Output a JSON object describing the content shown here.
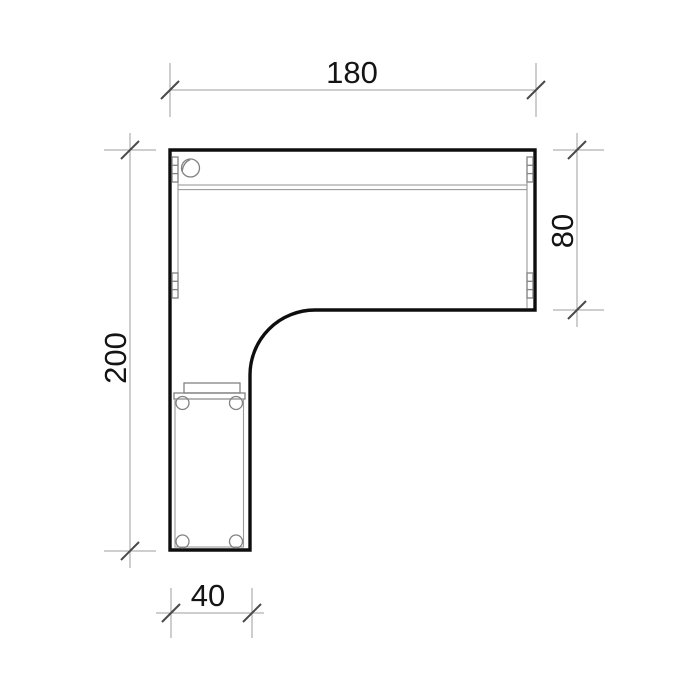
{
  "drawing": {
    "kind": "technical-plan-drawing",
    "dimensions": {
      "top": {
        "label": "180"
      },
      "right": {
        "label": "80"
      },
      "left": {
        "label": "200"
      },
      "bottom": {
        "label": "40"
      }
    },
    "colors": {
      "background": "#ffffff",
      "outline": "#0e0e0e",
      "detail_line": "#828282",
      "dimension_line": "#9c9c9c",
      "tick_mark": "#4a4a4a",
      "text": "#141414"
    }
  }
}
